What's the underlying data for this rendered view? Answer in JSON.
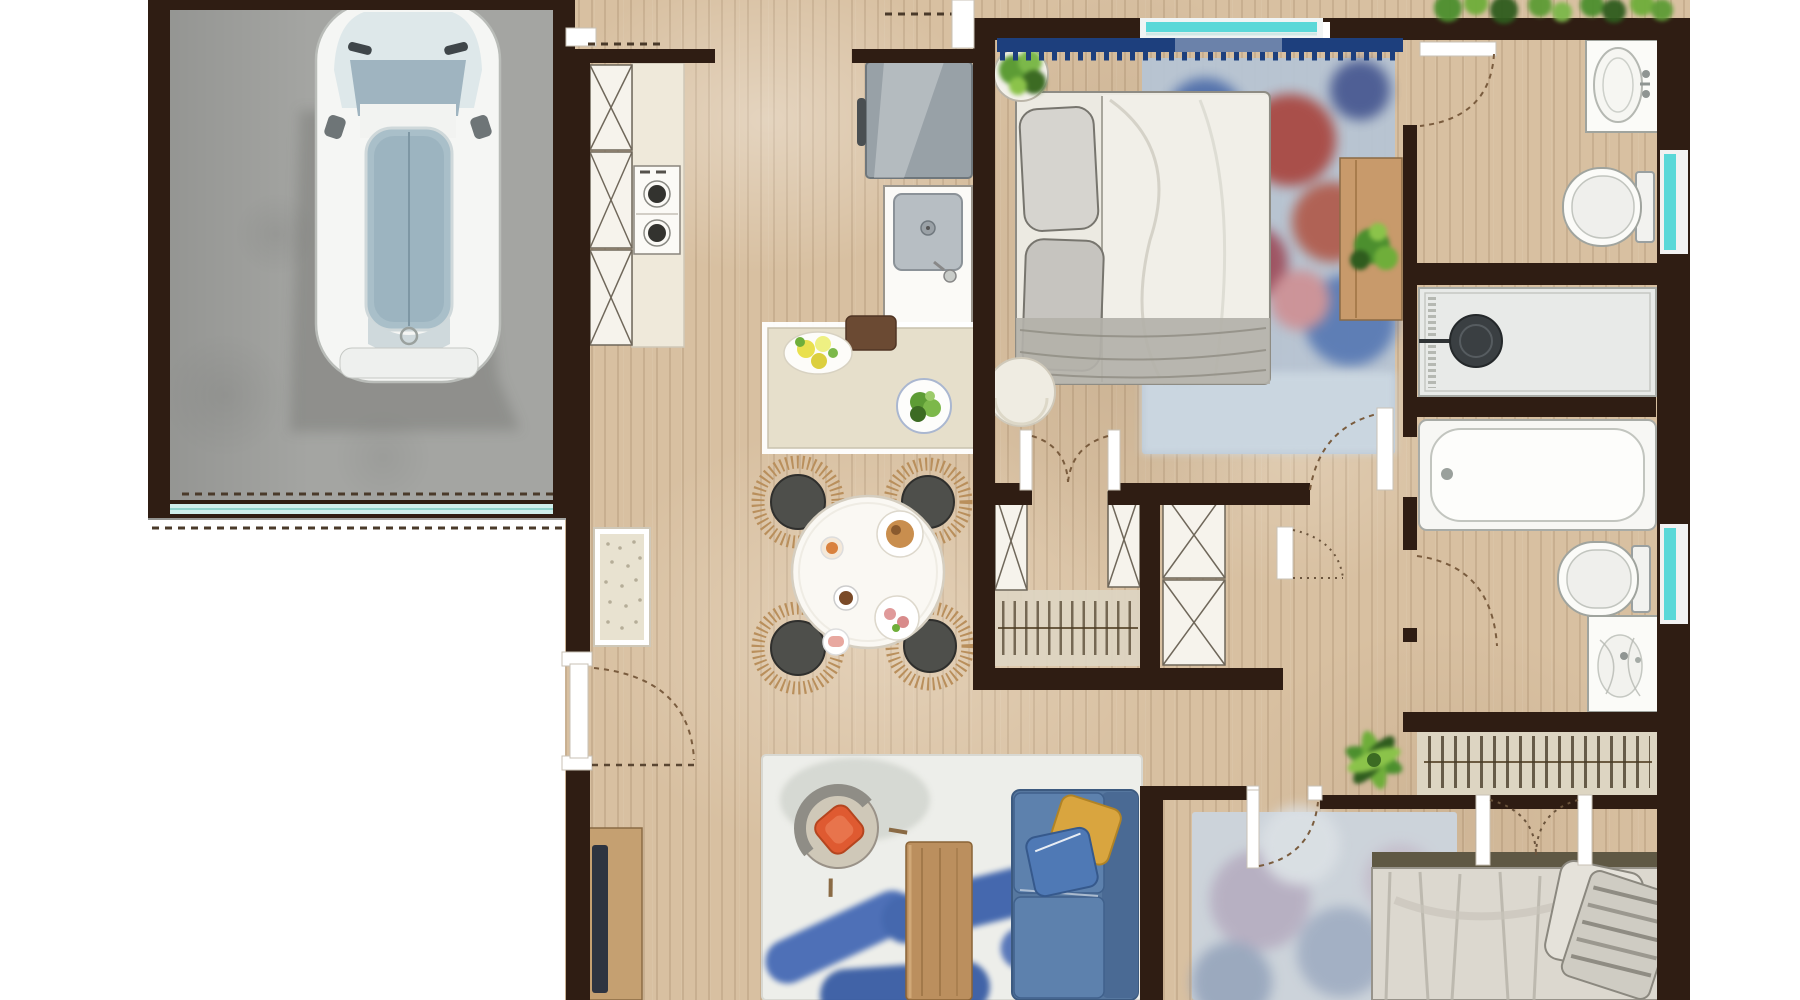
{
  "meta": {
    "kind": "floor-plan-rendering",
    "style": "watercolor top-down",
    "no_text_labels": true
  },
  "colors": {
    "wall": "#2f1d13",
    "wood": "#d8c0a1",
    "concrete": "#a4a5a2",
    "window": "#5ad8d8",
    "cabinet": "#f6f3ec",
    "counter": "#e6dfcb",
    "sofa": "#56779f",
    "pillow-yellow": "#d9a53f",
    "chair-orange": "#df5a31",
    "rattan": "#b98f5c",
    "seat": "#4e4f4b",
    "table-wood": "#bb8f5e",
    "tv": "#2e3440",
    "valance": "#1d3f7d",
    "green": "#5d9c35",
    "green-dark": "#3c6b23",
    "linen": "#efece4",
    "blanket": "#b3b1a9",
    "arc": "#7a5c3e"
  },
  "rooms": [
    {
      "id": "garage",
      "name": "garage",
      "floor": "concrete",
      "items": [
        "car",
        "garage-door",
        "driveway-dashes"
      ]
    },
    {
      "id": "kitchen",
      "name": "kitchen",
      "floor": "wood",
      "items": [
        "cabinet-run-with-x-fronts",
        "gas-stove-2-burners",
        "refrigerator",
        "sink-unit",
        "island-counter",
        "lemon-plate",
        "salad-bowl",
        "serving-tray"
      ]
    },
    {
      "id": "dining",
      "name": "dining-area",
      "floor": "wood",
      "items": [
        "round-table",
        "rattan-chair",
        "rattan-chair",
        "rattan-chair",
        "rattan-chair",
        "plates-and-cups"
      ]
    },
    {
      "id": "living",
      "name": "living-room",
      "floor": "wood",
      "items": [
        "blue-sofa",
        "yellow-throw-pillow",
        "blue-throw-pillow",
        "orange-armchair",
        "wood-coffee-table",
        "tv-console",
        "blue-stroke-rug"
      ]
    },
    {
      "id": "bedroom1",
      "name": "bedroom-1",
      "floor": "wood",
      "items": [
        "double-bed",
        "gray-pillows",
        "window-valance-scalloped",
        "red-blue-rug",
        "nightstand-with-plant",
        "potted-plant",
        "round-pouf"
      ]
    },
    {
      "id": "wardrobe1",
      "name": "walk-in-closet-1",
      "floor": "wood",
      "items": [
        "x-front-cabinets",
        "clothes-rail",
        "double-swing-doors"
      ]
    },
    {
      "id": "wardrobe2",
      "name": "walk-in-closet-2",
      "floor": "wood",
      "items": [
        "x-front-cabinets",
        "single-door"
      ]
    },
    {
      "id": "bathroom1",
      "name": "bathroom-top",
      "floor": "wood",
      "items": [
        "washbasin",
        "toilet",
        "window",
        "swing-door"
      ]
    },
    {
      "id": "bathroom2",
      "name": "shower-room",
      "floor": "wood",
      "items": [
        "walk-in-shower",
        "rain-shower-head",
        "bathtub"
      ]
    },
    {
      "id": "bathroom3",
      "name": "bathroom-lower",
      "floor": "wood",
      "items": [
        "toilet",
        "washbasin",
        "window",
        "swing-door"
      ]
    },
    {
      "id": "closet",
      "name": "linen-closet",
      "floor": "wood",
      "items": [
        "clothes-rail",
        "sliding-double-doors",
        "potted-plant"
      ]
    },
    {
      "id": "bedroom2",
      "name": "bedroom-2",
      "floor": "wood",
      "items": [
        "double-bed",
        "striped-pillow",
        "washed-blue-rug",
        "swing-door"
      ]
    }
  ],
  "counts": {
    "dining_chairs": 4,
    "windows": 3,
    "x_front_panels": 7,
    "beds": 2,
    "toilets": 2,
    "basins": 3
  }
}
